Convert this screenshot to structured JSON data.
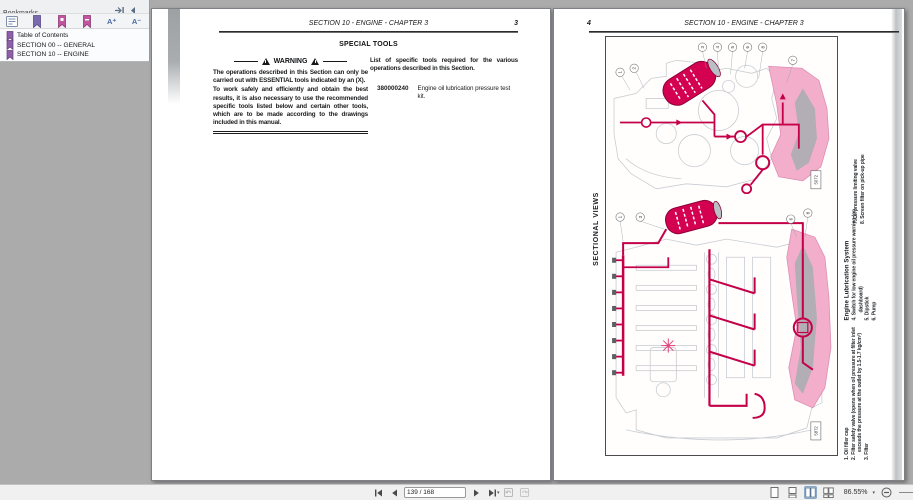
{
  "bookmarks_panel": {
    "title": "Bookmarks",
    "toolbar": {
      "font_larger": "A⁺",
      "font_smaller": "A⁻"
    },
    "items": [
      {
        "label": "Table of Contents"
      },
      {
        "label": "SECTION 00 -- GENERAL"
      },
      {
        "label": "SECTION 10 -- ENGINE"
      }
    ]
  },
  "left_page": {
    "header_title": "SECTION 10 - ENGINE - CHAPTER 3",
    "page_number": "3",
    "section_title": "SPECIAL TOOLS",
    "warning_label": "WARNING",
    "warning_para1": "The operations described in this Section can only be carried out with ESSENTIAL tools indicated by an (X).",
    "warning_para2": "To work safely and efficiently and obtain the best results, it is also necessary to use the recommended specific tools listed below and certain other tools, which are to be made according to the drawings included in this manual.",
    "tools_intro": "List of specific tools required for the various operations described in this Section.",
    "tool_code": "380000240",
    "tool_desc": "Engine oil lubrication pressure test kit."
  },
  "right_page": {
    "page_number": "4",
    "header_title": "SECTION 10 - ENGINE - CHAPTER 3",
    "side_label": "SECTIONAL VIEWS",
    "figure": {
      "top_tag": "5072",
      "bottom_tag": "5872",
      "top_callouts": [
        "1",
        "2",
        "3",
        "4",
        "5",
        "6",
        "8",
        "7"
      ],
      "bottom_callouts": [
        "1",
        "3",
        "6",
        "8"
      ]
    },
    "legend_top_items": [
      "7. Oil pressure limiting valve",
      "8. Screen filter on pick-up pipe"
    ],
    "legend_mid_heading": "Engine Lubrication System",
    "legend_mid_items": [
      "4. Switch for low engine oil pressure warning (on dashboard)",
      "5. Dipstick",
      "6. Pump"
    ],
    "legend_bottom_items": [
      "1. Oil filler cap",
      "2. Filter safety valve (opens when oil pressure at filter inlet exceeds the pressure at the outlet by 1.5-1.7 kg/cm²)",
      "3. Filter"
    ]
  },
  "status_bar": {
    "page_field": "139 / 168",
    "zoom_level": "86.55%"
  },
  "colors": {
    "accent_magenta": "#d40050",
    "circuit_red": "#c40049",
    "pink_fill": "#f3aecb",
    "canvas_gray": "#ababab"
  }
}
